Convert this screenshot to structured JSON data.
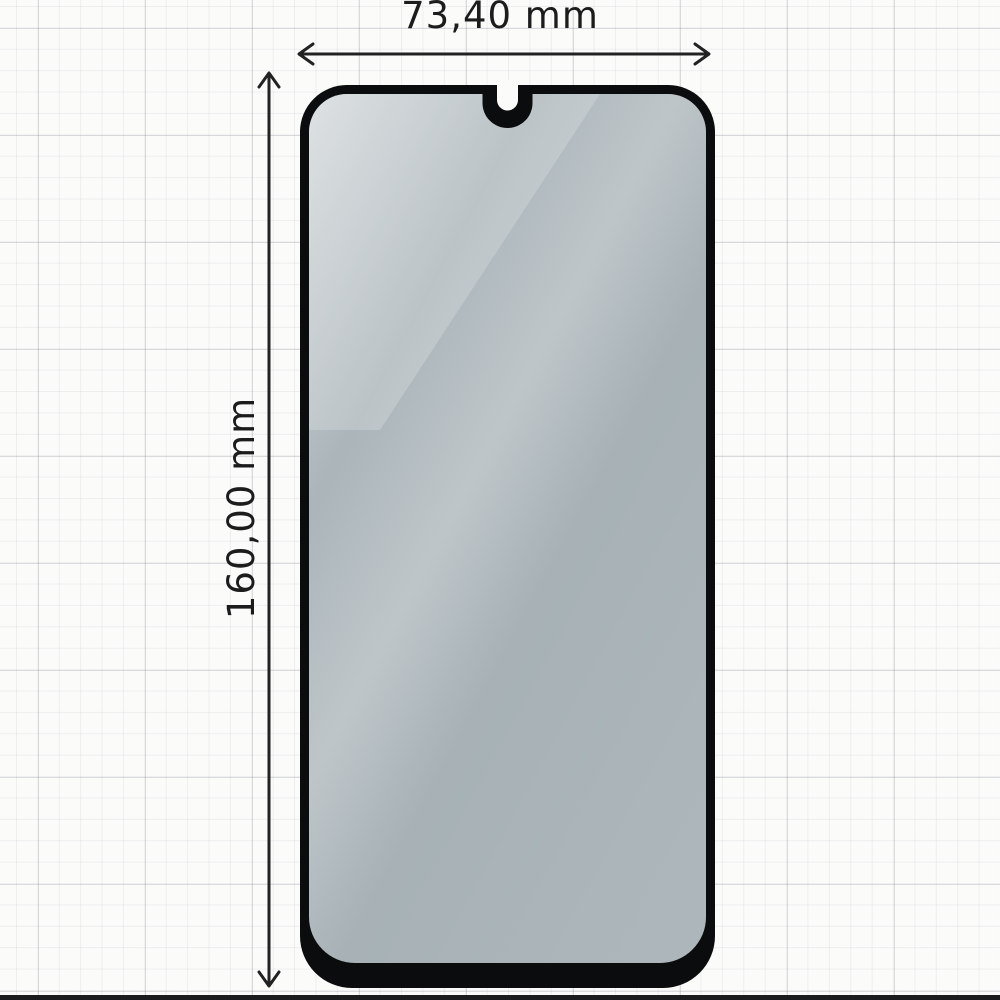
{
  "page": {
    "type": "product-dimension-diagram",
    "background": "#fbfbfa",
    "subject": "tempered-glass-screen-protector-with-u-notch"
  },
  "dimensions": {
    "width": {
      "label": "73,40 mm"
    },
    "height": {
      "label": "160,00 mm"
    }
  },
  "protector": {
    "border_color": "#0b0c0d",
    "glass_tint": "#e6f1f6",
    "notch_style": "u-shaped-center-notch",
    "bottom_bezel": "thick"
  },
  "colors": {
    "label_text": "#1c1c1c",
    "arrow": "#222222",
    "grid_minor": "rgba(120,128,138,0.10)",
    "grid_major": "rgba(100,108,118,0.22)",
    "photo_bottom_edge": "#1a1c1e"
  }
}
